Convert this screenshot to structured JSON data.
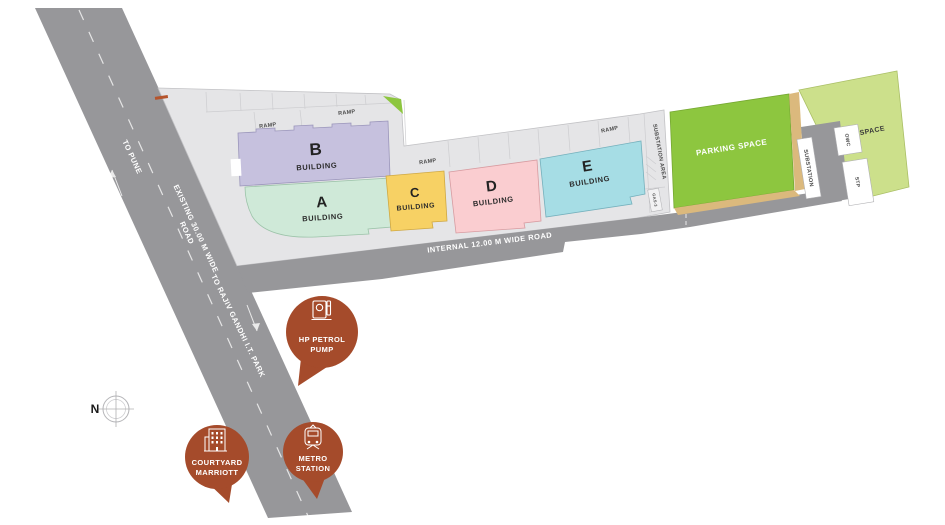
{
  "compass": {
    "label": "N"
  },
  "roads": {
    "to_pune": "TO PUNE",
    "existing_line1": "EXISTING 30.00 M WIDE",
    "existing_line2": "ROAD",
    "to_rajiv": "TO RAJIV GANDHI I.T. PARK",
    "internal": "INTERNAL 12.00 M WIDE ROAD"
  },
  "ramps": [
    "RAMP",
    "RAMP",
    "RAMP",
    "RAMP"
  ],
  "buildings": [
    {
      "id": "A",
      "label": "BUILDING",
      "color": "#cfe9d8"
    },
    {
      "id": "B",
      "label": "BUILDING",
      "color": "#c6c1de"
    },
    {
      "id": "C",
      "label": "BUILDING",
      "color": "#f7d164"
    },
    {
      "id": "D",
      "label": "BUILDING",
      "color": "#facdd0"
    },
    {
      "id": "E",
      "label": "BUILDING",
      "color": "#a6dde5"
    }
  ],
  "areas": {
    "parking": "PARKING SPACE",
    "open_space": "OPEN SPACE",
    "substation_area": "SUBSTATION AREA",
    "substation": "SUBSTATION",
    "owc": "OWC",
    "stp": "STP",
    "gas": "GAS-3"
  },
  "markers": [
    {
      "id": "hp-petrol-pump",
      "line1": "HP PETROL",
      "line2": "PUMP"
    },
    {
      "id": "courtyard-marriott",
      "line1": "COURTYARD",
      "line2": "MARRIOTT"
    },
    {
      "id": "metro-station",
      "line1": "METRO",
      "line2": "STATION"
    }
  ],
  "colors": {
    "road": "#97979a",
    "podium": "#e5e5e7",
    "parking": "#8dc63f",
    "open_space": "#cce08b",
    "tan": "#dbb97d",
    "marker": "#a54b2b",
    "accent_red": "#b5542c",
    "green_corner": "#8dc63f"
  }
}
